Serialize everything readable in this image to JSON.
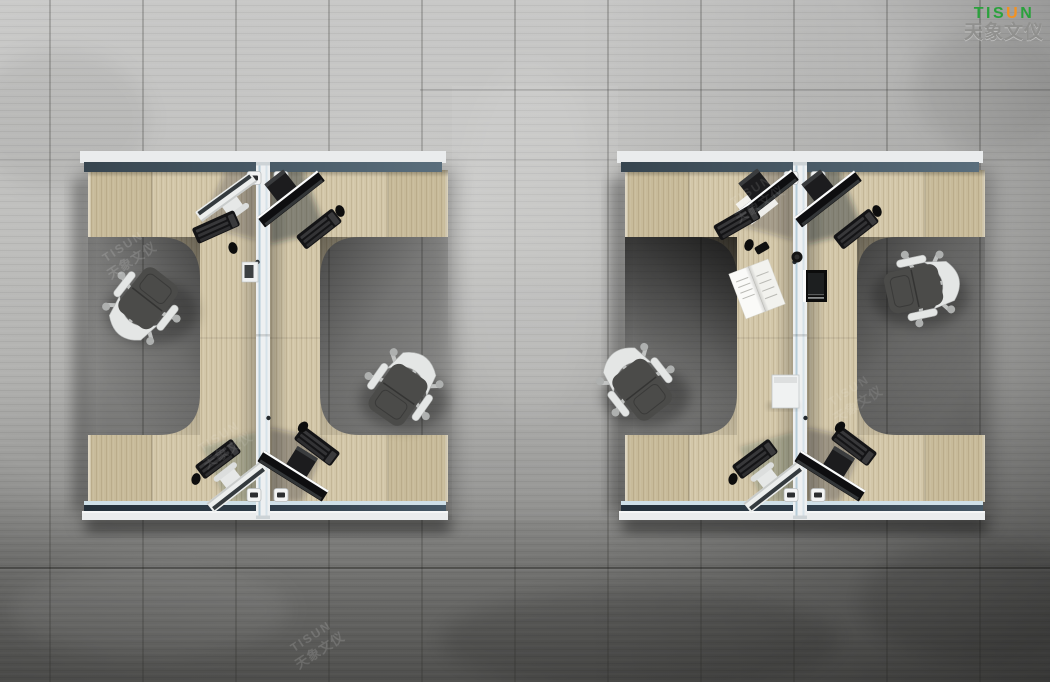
{
  "logo": {
    "prefix": "TIS",
    "accent": "U",
    "suffix": "N",
    "subtitle": "天象文仪"
  },
  "watermark": {
    "latin": "TISUN",
    "cjk": "天象文仪"
  },
  "scene": {
    "subject": "Top-down render of two four-person office workstation clusters on a concrete floor",
    "cluster_count": 2,
    "workstations_per_cluster": 4,
    "chairs_visible": 4,
    "monitors_visible": 9,
    "keyboards_visible": 8,
    "extra_items": [
      "open magazine",
      "divider-mounted screen",
      "divider storage box",
      "desk grommets"
    ]
  },
  "palette": {
    "floor-top": "#cccccb",
    "floor-dark": "#595957",
    "wood": "#d3c7a9",
    "slate": "#41505c",
    "rail": "#eaeced",
    "blue-band": "#cfe0e8",
    "divider": "#eef0f1",
    "divider-blue": "#b7cdd9",
    "device": "#141416",
    "chair-fabric": "#4b4b49",
    "chair-white": "#e4e6e5",
    "metal": "#c6c8c7",
    "logo-green": "#2aa23c",
    "logo-orange": "#f29222",
    "subtitle-gray": "#8f8f8d"
  }
}
